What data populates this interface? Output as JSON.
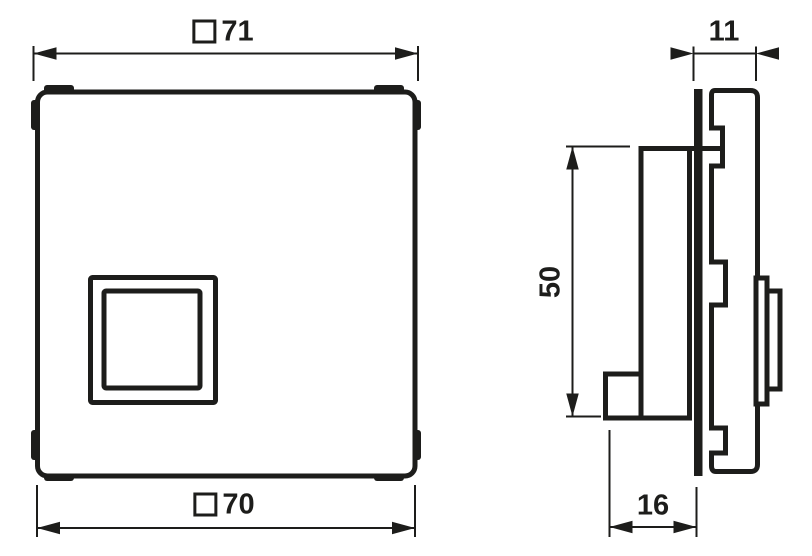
{
  "diagram": {
    "type": "technical dimension drawing",
    "background_color": "#ffffff",
    "line_color": "#1d1d1b",
    "dimensions": {
      "front_width_top": {
        "symbol": "square",
        "value": "71"
      },
      "front_width_bottom": {
        "symbol": "square",
        "value": "70"
      },
      "side_depth_top": {
        "symbol": "",
        "value": "11"
      },
      "side_height": {
        "symbol": "",
        "value": "50"
      },
      "side_depth_bottom": {
        "symbol": "",
        "value": "16"
      }
    }
  }
}
